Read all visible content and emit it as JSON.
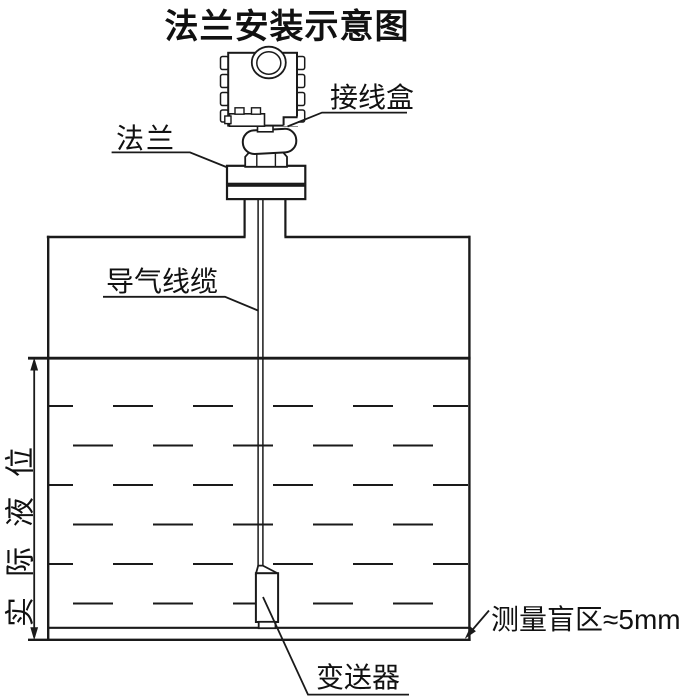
{
  "title": "法兰安装示意图",
  "labels": {
    "junction_box": "接线盒",
    "flange": "法兰",
    "air_cable": "导气线缆",
    "actual_level": "实际液位",
    "transmitter": "变送器",
    "blind_zone": "测量盲区≈5mm"
  },
  "colors": {
    "line": "#1a1a1a",
    "text": "#111111",
    "background": "#ffffff"
  }
}
